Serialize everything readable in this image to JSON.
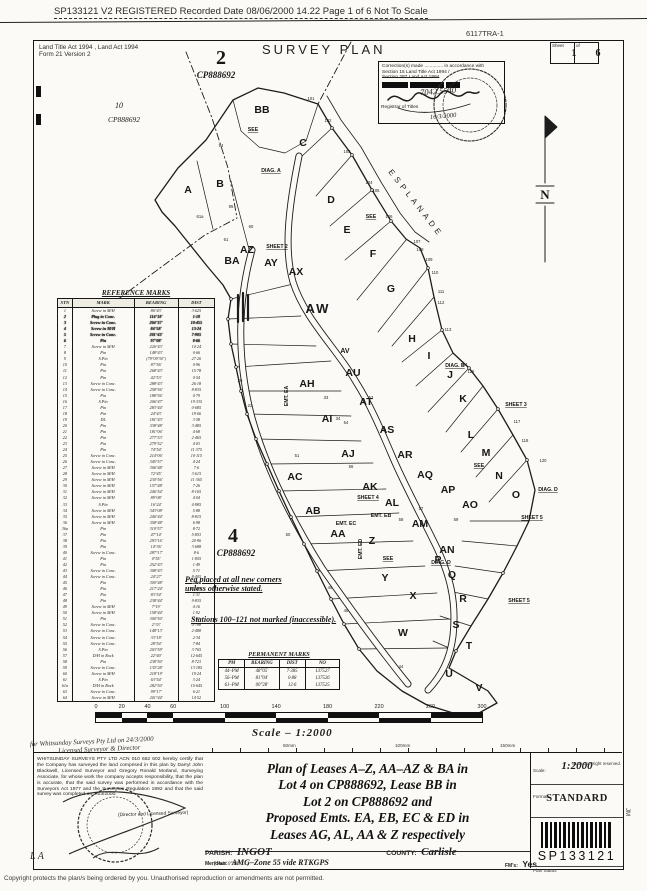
{
  "header": {
    "line": "SP133121 V2 REGISTERED Recorded Date 08/06/2000 14.22 Page 1 of 6  Not To Scale",
    "ref": "6117TRA-1"
  },
  "form": {
    "acts_line1": "Land Title Act 1994 , Land Act 1994",
    "acts_line2": "Form 21 Version 2",
    "title": "SURVEY PLAN",
    "sheet_label": "Sheet",
    "of_label": "of",
    "sheet_no": "1",
    "sheet_total": "6"
  },
  "correction": {
    "line1": "Correction(s) made .............. in accordance with",
    "line2": "Section 15 Land Title Act 1994 /",
    "line3": "Section 287 Land Act 1994",
    "hand_number": "7042.5540",
    "registrar_label": "Registrar of Titles",
    "hand_date": "16/3/2000"
  },
  "map": {
    "esplanade": "ESPLANADE",
    "north": "N",
    "notes": [
      "Peg placed at all new corners",
      "unless otherwise stated.",
      "Stations 100–121 not marked (inaccessible)."
    ],
    "parcels": [
      {
        "t": "2",
        "x": 221,
        "y": 64,
        "cls": "pbig"
      },
      {
        "t": "CP888692",
        "x": 216,
        "y": 78,
        "cls": "pcp"
      },
      {
        "t": "10",
        "x": 119,
        "y": 108,
        "cls": "pnum"
      },
      {
        "t": "CP888692",
        "x": 124,
        "y": 122,
        "cls": "pcp sm"
      },
      {
        "t": "4",
        "x": 233,
        "y": 542,
        "cls": "pbig"
      },
      {
        "t": "CP888692",
        "x": 236,
        "y": 556,
        "cls": "pcp"
      }
    ],
    "lots": [
      {
        "t": "A",
        "x": 188,
        "y": 193
      },
      {
        "t": "B",
        "x": 220,
        "y": 187
      },
      {
        "t": "C",
        "x": 303,
        "y": 146
      },
      {
        "t": "D",
        "x": 331,
        "y": 203
      },
      {
        "t": "E",
        "x": 347,
        "y": 233
      },
      {
        "t": "F",
        "x": 373,
        "y": 257
      },
      {
        "t": "G",
        "x": 391,
        "y": 292
      },
      {
        "t": "H",
        "x": 412,
        "y": 342
      },
      {
        "t": "I",
        "x": 429,
        "y": 359
      },
      {
        "t": "J",
        "x": 450,
        "y": 378
      },
      {
        "t": "K",
        "x": 463,
        "y": 402
      },
      {
        "t": "L",
        "x": 471,
        "y": 438
      },
      {
        "t": "M",
        "x": 486,
        "y": 456
      },
      {
        "t": "N",
        "x": 499,
        "y": 479
      },
      {
        "t": "O",
        "x": 516,
        "y": 498
      },
      {
        "t": "P",
        "x": 438,
        "y": 563
      },
      {
        "t": "Q",
        "x": 452,
        "y": 578
      },
      {
        "t": "R",
        "x": 463,
        "y": 602
      },
      {
        "t": "S",
        "x": 456,
        "y": 628
      },
      {
        "t": "T",
        "x": 469,
        "y": 649
      },
      {
        "t": "U",
        "x": 449,
        "y": 677
      },
      {
        "t": "V",
        "x": 479,
        "y": 691
      },
      {
        "t": "W",
        "x": 403,
        "y": 636
      },
      {
        "t": "X",
        "x": 413,
        "y": 599
      },
      {
        "t": "Y",
        "x": 385,
        "y": 581
      },
      {
        "t": "Z",
        "x": 372,
        "y": 544
      },
      {
        "t": "AA",
        "x": 338,
        "y": 537
      },
      {
        "t": "AB",
        "x": 313,
        "y": 514
      },
      {
        "t": "AC",
        "x": 295,
        "y": 480
      },
      {
        "t": "AH",
        "x": 307,
        "y": 387
      },
      {
        "t": "AI",
        "x": 327,
        "y": 422
      },
      {
        "t": "AJ",
        "x": 348,
        "y": 457
      },
      {
        "t": "AK",
        "x": 370,
        "y": 490
      },
      {
        "t": "AL",
        "x": 392,
        "y": 506
      },
      {
        "t": "AM",
        "x": 420,
        "y": 527
      },
      {
        "t": "AN",
        "x": 447,
        "y": 553
      },
      {
        "t": "AO",
        "x": 470,
        "y": 508
      },
      {
        "t": "AP",
        "x": 448,
        "y": 493
      },
      {
        "t": "AQ",
        "x": 425,
        "y": 478
      },
      {
        "t": "AR",
        "x": 405,
        "y": 458
      },
      {
        "t": "AS",
        "x": 387,
        "y": 433
      },
      {
        "t": "AT",
        "x": 366,
        "y": 405
      },
      {
        "t": "AU",
        "x": 353,
        "y": 376
      },
      {
        "t": "AV",
        "x": 345,
        "y": 353,
        "cls": "sm"
      },
      {
        "t": "AW",
        "x": 318,
        "y": 313,
        "cls": "heavy"
      },
      {
        "t": "AX",
        "x": 296,
        "y": 275
      },
      {
        "t": "AY",
        "x": 271,
        "y": 266
      },
      {
        "t": "AZ",
        "x": 247,
        "y": 253
      },
      {
        "t": "BA",
        "x": 232,
        "y": 264
      },
      {
        "t": "BB",
        "x": 262,
        "y": 113
      }
    ],
    "labels": [
      {
        "t": "SEE",
        "x": 253,
        "y": 131,
        "u": 1
      },
      {
        "t": "DIAG. A",
        "x": 271,
        "y": 172,
        "u": 1
      },
      {
        "t": "SHEET 2",
        "x": 277,
        "y": 248,
        "u": 1
      },
      {
        "t": "SEE",
        "x": 371,
        "y": 218,
        "u": 1
      },
      {
        "t": "DIAG. B",
        "x": 455,
        "y": 367,
        "u": 1
      },
      {
        "t": "SHEET 3",
        "x": 516,
        "y": 406,
        "u": 1
      },
      {
        "t": "SEE",
        "x": 479,
        "y": 467,
        "u": 1
      },
      {
        "t": "DIAG. D",
        "x": 548,
        "y": 491,
        "u": 1
      },
      {
        "t": "SHEET 5",
        "x": 532,
        "y": 519,
        "u": 1
      },
      {
        "t": "SHEET 4",
        "x": 368,
        "y": 499,
        "u": 1
      },
      {
        "t": "SEE",
        "x": 388,
        "y": 560,
        "u": 1
      },
      {
        "t": "DIAG. D",
        "x": 441,
        "y": 564,
        "u": 1
      },
      {
        "t": "SHEET 5",
        "x": 519,
        "y": 602,
        "u": 1
      },
      {
        "t": "EMT. EC",
        "x": 346,
        "y": 525
      },
      {
        "t": "EMT. EB",
        "x": 381,
        "y": 517
      },
      {
        "t": "EMT. ED",
        "x": 362,
        "y": 549,
        "rot": -90
      },
      {
        "t": "EMT. EA",
        "x": 288,
        "y": 396,
        "rot": -90
      }
    ],
    "stations": [
      [
        "101",
        311,
        100
      ],
      [
        "102",
        328,
        122
      ],
      [
        "103",
        347,
        153
      ],
      [
        "104",
        369,
        184
      ],
      [
        "105",
        376,
        192
      ],
      [
        "106",
        389,
        218
      ],
      [
        "107",
        417,
        243
      ],
      [
        "108",
        420,
        251
      ],
      [
        "109",
        429,
        261
      ],
      [
        "110",
        435,
        274
      ],
      [
        "111",
        441,
        293
      ],
      [
        "112",
        441,
        304
      ],
      [
        "113",
        448,
        331
      ],
      [
        "114",
        464,
        366
      ],
      [
        "115",
        471,
        373
      ],
      [
        "117",
        517,
        423
      ],
      [
        "118",
        525,
        442
      ],
      [
        "120",
        543,
        462
      ],
      [
        "94",
        221,
        147
      ],
      [
        "95",
        231,
        208
      ],
      [
        "60",
        251,
        228
      ],
      [
        "61",
        226,
        241
      ],
      [
        "61a",
        200,
        218
      ],
      [
        "20",
        240,
        382
      ],
      [
        "22",
        250,
        407
      ],
      [
        "33",
        326,
        399
      ],
      [
        "34",
        338,
        420
      ],
      [
        "51",
        297,
        457
      ],
      [
        "53",
        371,
        399
      ],
      [
        "54",
        346,
        424
      ],
      [
        "56",
        351,
        468
      ],
      [
        "57",
        421,
        510
      ],
      [
        "58",
        401,
        521
      ],
      [
        "59",
        456,
        521
      ],
      [
        "50",
        288,
        536
      ],
      [
        "49",
        330,
        589
      ],
      [
        "48",
        346,
        612
      ],
      [
        "44",
        401,
        668
      ]
    ]
  },
  "reference_marks": {
    "title": "REFERENCE MARKS",
    "headers": [
      "STN",
      "MARK",
      "BEARING",
      "DIST"
    ],
    "rows": [
      [
        "1",
        "Screw in M/H",
        "86°43'",
        "3·625"
      ],
      [
        "2",
        "Plug in Conc.",
        "114°18'",
        "1·18"
      ],
      [
        "3",
        "Screw in Conc.",
        "204°37'",
        "10·455"
      ],
      [
        "4",
        "Screw in M/H",
        "84°58'",
        "13·24"
      ],
      [
        "5",
        "Screw in Conc.",
        "201°43'",
        "7·905"
      ],
      [
        "6",
        "Pin",
        "97°08'",
        "0·66"
      ],
      [
        "7",
        "Screw in M/H",
        "226°43'",
        "10·24"
      ],
      [
        "8",
        "Pin",
        "148°43'",
        "0·66"
      ],
      [
        "9",
        "S.Pin",
        "(79°09'30\")",
        "27·26"
      ],
      [
        "10",
        "Pin",
        "87°56'",
        "0·96"
      ],
      [
        "11",
        "Pin",
        "268°43'",
        "15·78"
      ],
      [
        "12",
        "Pin",
        "42°53'",
        "0·54"
      ],
      [
        "13",
        "Screw in Conc.",
        "288°43'",
        "26·18"
      ],
      [
        "14",
        "Screw in Conc.",
        "258°56'",
        "8·835"
      ],
      [
        "15",
        "Pin",
        "188°56'",
        "0·79"
      ],
      [
        "16",
        "S.Pin",
        "206°47'",
        "19·335"
      ],
      [
        "17",
        "Pin",
        "283°44'",
        "0·685"
      ],
      [
        "18",
        "Pin",
        "24°43'",
        "19·06"
      ],
      [
        "19",
        "DL",
        "181°43'",
        "3·58"
      ],
      [
        "20",
        "Pin",
        "338°48'",
        "3·485"
      ],
      [
        "21",
        "Pin",
        "181°06'",
        "4·68"
      ],
      [
        "22",
        "Pin",
        "277°53'",
        "2·465"
      ],
      [
        "23",
        "Pin",
        "279°52'",
        "4·03"
      ],
      [
        "24",
        "Pin",
        "74°54'",
        "11·375"
      ],
      [
        "25",
        "Screw in Conc.",
        "214°06'",
        "10·115"
      ],
      [
        "26",
        "Screw in Conc.",
        "345°57'",
        "4·24"
      ],
      [
        "27",
        "Screw in M/H",
        "306°48'",
        "7·6"
      ],
      [
        "28",
        "Screw in M/H",
        "72°45'",
        "3·615"
      ],
      [
        "29",
        "Screw in M/H",
        "230°56'",
        "11·365"
      ],
      [
        "30",
        "Screw in M/H",
        "157°48'",
        "7·26"
      ],
      [
        "31",
        "Screw in M/H",
        "246°54'",
        "8·165"
      ],
      [
        "32",
        "Screw in M/H",
        "89°08'",
        "4·04"
      ],
      [
        "33",
        "S.Pin",
        "16°24'",
        "4·985"
      ],
      [
        "34",
        "Screw in M/H",
        "343°08'",
        "5·88"
      ],
      [
        "35",
        "Screw in M/H",
        "246°44'",
        "8·815"
      ],
      [
        "36",
        "Screw in M/H",
        "358°48'",
        "6·98"
      ],
      [
        "36a",
        "Pin",
        "310°57'",
        "8·72"
      ],
      [
        "37",
        "Pin",
        "47°14'",
        "5·853"
      ],
      [
        "38",
        "Pin",
        "293°16'",
        "20·96"
      ],
      [
        "39",
        "Pin",
        "14°36'",
        "3·688"
      ],
      [
        "40",
        "Screw in Conc.",
        "287°17'",
        "8·6"
      ],
      [
        "41",
        "Pin",
        "0°55'",
        "1·855"
      ],
      [
        "42",
        "Pin",
        "252°43'",
        "1·49"
      ],
      [
        "43",
        "Screw in Conc.",
        "308°43'",
        "5·71"
      ],
      [
        "44",
        "Screw in Conc.",
        "24°27'",
        "8·405"
      ],
      [
        "45",
        "Pin",
        "300°48'",
        "2·86"
      ],
      [
        "46",
        "Pin",
        "217°24'",
        "10·825"
      ],
      [
        "47",
        "Pin",
        "83°54'",
        "1·31"
      ],
      [
        "48",
        "Pin",
        "238°44'",
        "9·835"
      ],
      [
        "49",
        "Screw in M/H",
        "7°19'",
        "4·16"
      ],
      [
        "50",
        "Screw in M/H",
        "158°44'",
        "1·92"
      ],
      [
        "51",
        "Pin",
        "300°50'",
        "2·53"
      ],
      [
        "52",
        "Screw in Conc.",
        "2°33'",
        "0·788"
      ],
      [
        "53",
        "Screw in Conc.",
        "148°13'",
        "2·488"
      ],
      [
        "54",
        "Screw in Conc.",
        "33°18'",
        "2·34"
      ],
      [
        "55",
        "Screw in Conc.",
        "28°54'",
        "7·84"
      ],
      [
        "56",
        "S.Pin",
        "203°59'",
        "3·765"
      ],
      [
        "57",
        "D/H in Rock",
        "22°40'",
        "12·645"
      ],
      [
        "58",
        "Pin",
        "238°50'",
        "8·723"
      ],
      [
        "59",
        "Screw in Conc.",
        "135°28'",
        "13·185"
      ],
      [
        "60",
        "Screw in M/H",
        "218°19'",
        "19·24"
      ],
      [
        "61",
        "S.Pin",
        "63°54'",
        "3·24"
      ],
      [
        "61a",
        "D/H in Rock",
        "282°50'",
        "10·645"
      ],
      [
        "63",
        "Screw in Conc.",
        "99°17'",
        "6·21"
      ],
      [
        "64",
        "Screw in M/H",
        "201°44'",
        "14·52"
      ]
    ]
  },
  "permanent_marks": {
    "title": "PERMANENT MARKS",
    "headers": [
      "PM",
      "BEARING",
      "DIST",
      "NO"
    ],
    "rows": [
      [
        "44–PM",
        "48°05'",
        "7·385",
        "137527"
      ],
      [
        "56–PM",
        "81°04'",
        "0·88",
        "137526"
      ],
      [
        "61–PM",
        "00°28'",
        "12·6",
        "137525"
      ]
    ]
  },
  "scale_bar": {
    "ticks": [
      0,
      20,
      40,
      60,
      100,
      140,
      180,
      220,
      260,
      300
    ],
    "label": "Scale – 1:2000"
  },
  "footer": {
    "ruler_labels": [
      {
        "t": "50mm",
        "x": 283
      },
      {
        "t": "100mm",
        "x": 395
      },
      {
        "t": "150mm",
        "x": 500
      }
    ],
    "state_copyright": "State copyright reserved.",
    "hand_note1": "for Whitsunday Surveys Pty Ltd on 24/3/2000",
    "hand_note2": "Licensed Surveyor & Director",
    "certification": "WHITSUNDAY SURVEYS PTY LTD  ACN 010 652 602 hereby certify that the Company has surveyed the land comprised in this plan by Darryl John Blackwell, Licensed Surveyor and Gregory Ronald Morland, Surveying Associate, for whose work the company accepts responsibility, that the plan is accurate, that the said survey was performed in accordance with the Surveyors Act 1977 and the Surveyors Regulation 1992 and that the said survey was completed on 24/3/2000.",
    "sign_label": "(Director and Licensed Surveyor)",
    "description_lines": [
      "Plan of Leases A–Z, AA–AZ & BA in",
      "Lot 4 on CP888692, Lease BB in",
      "Lot 2 on CP888692 and",
      "Proposed Emts. EA, EB, EC & ED in",
      "Leases AG, AL, AA & Z respectively"
    ],
    "parish_label": "PARISH:",
    "parish": "INGOT",
    "county_label": "COUNTY:",
    "county": "Carlisle",
    "meridian_label": "Meridian:",
    "meridian": "AMG–Zone 55 vide RTKGPS",
    "meridian_hand": "[ Add 0°48' … ]",
    "fms_label": "FM's:",
    "fms": "Yes",
    "scale_label": "Scale:",
    "scale": "1:2000",
    "format_label": "Format:",
    "format": "STANDARD",
    "plan_no": "SP133121",
    "plan_status_label": "Plan Status",
    "side_initials": "JM",
    "hand_initials": "L A",
    "bottom_copyright": "Copyright protects the plan/s being ordered by you.  Unauthorised reproduction or amendments are not permitted."
  }
}
